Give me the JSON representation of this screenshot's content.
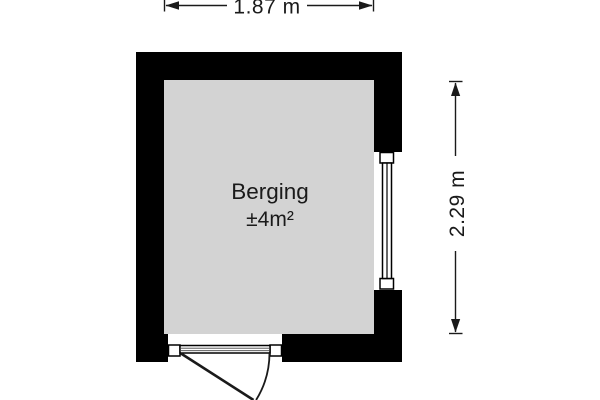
{
  "floorplan": {
    "room": {
      "name": "Berging",
      "area": "±4m²"
    },
    "dimensions": {
      "width_label": "1.87 m",
      "height_label": "2.29 m"
    },
    "elements": {
      "window": "window on right wall",
      "door": "outward swinging door on bottom wall"
    },
    "colors": {
      "wall": "#000000",
      "floor": "#d3d3d3",
      "background": "#ffffff",
      "line": "#1a1a1a"
    }
  }
}
